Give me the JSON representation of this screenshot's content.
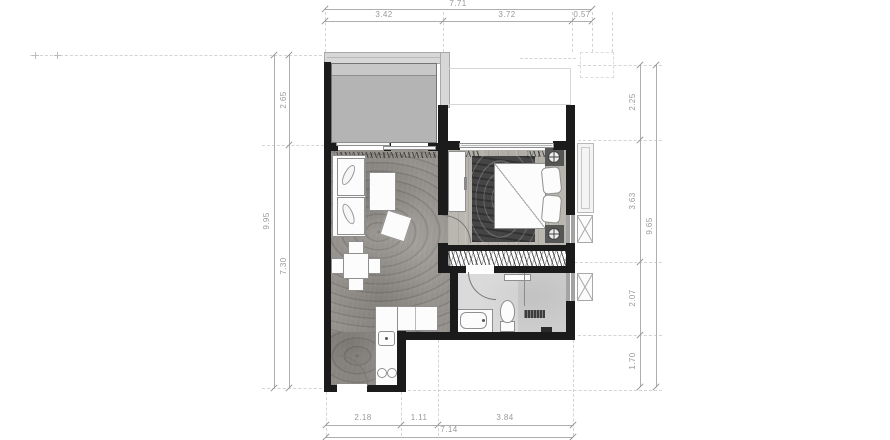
{
  "document": {
    "type": "apartment floor plan drawing"
  },
  "dimensions": {
    "top": {
      "overall": "7.71",
      "segments": [
        "3.42",
        "3.72",
        "0.57"
      ]
    },
    "left": {
      "overall": "9.95",
      "segments": [
        "2.65",
        "7.30"
      ]
    },
    "right": {
      "overall": "9.65",
      "segments": [
        "2.25",
        "3.63",
        "2.07",
        "1.70"
      ]
    },
    "bottom": {
      "overall": "7.14",
      "segments": [
        "2.18",
        "1.11",
        "3.84"
      ]
    }
  },
  "colors": {
    "wall": "#1b1b1b",
    "wood": "#94908b",
    "bedroomFloor": "#bab7b1",
    "rug": "#454545",
    "pool": "#b4b4b4",
    "deck": "#d7d7d7",
    "bath": "#dadada",
    "furnStroke": "#8f8f8f",
    "dimText": "#97999b",
    "dimLine": "#aeaeae",
    "dash": "#d4d4d4"
  }
}
